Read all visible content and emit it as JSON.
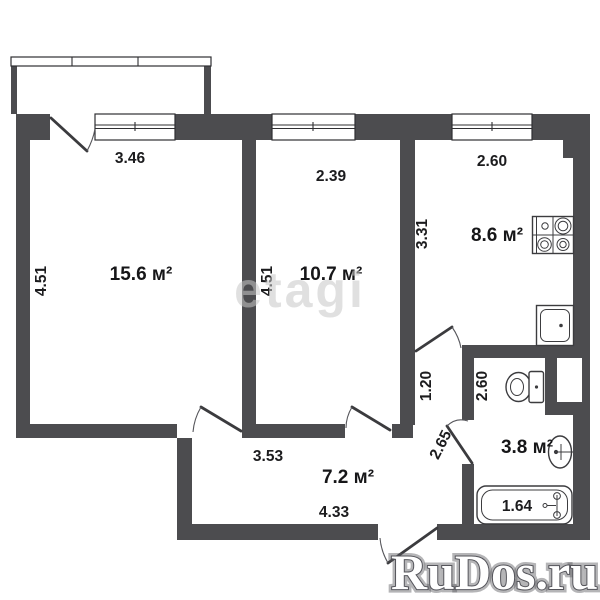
{
  "plan": {
    "rooms": [
      {
        "id": "living-room",
        "area": "15.6 м²"
      },
      {
        "id": "bedroom",
        "area": "10.7 м²"
      },
      {
        "id": "kitchen",
        "area": "8.6 м²"
      },
      {
        "id": "hallway",
        "area": "7.2 м²"
      },
      {
        "id": "bathroom",
        "area": "3.8 м²"
      }
    ],
    "dimensions": [
      {
        "id": "living-width",
        "value": "3.46"
      },
      {
        "id": "bedroom-width",
        "value": "2.39"
      },
      {
        "id": "kitchen-width",
        "value": "2.60"
      },
      {
        "id": "living-depth",
        "value": "4.51"
      },
      {
        "id": "bedroom-depth",
        "value": "4.51"
      },
      {
        "id": "kitchen-depth",
        "value": "3.31"
      },
      {
        "id": "inner-hall-width",
        "value": "1.20"
      },
      {
        "id": "bathroom-depth",
        "value": "2.60"
      },
      {
        "id": "bathroom-door",
        "value": "2.65"
      },
      {
        "id": "hallway-top-width",
        "value": "3.53"
      },
      {
        "id": "hallway-bottom-width",
        "value": "4.33"
      },
      {
        "id": "bathtub-length",
        "value": "1.64"
      }
    ],
    "fixtures": [
      "stove-icon",
      "kitchen-sink-icon",
      "toilet-icon",
      "washbasin-icon",
      "bathtub-icon"
    ],
    "watermarks": {
      "center": "etagi",
      "bottom_right": "RuDos.ru"
    },
    "colors": {
      "wall": "#4c4c4f",
      "text": "#1c1c1e",
      "watermark_center": "#c8c8c8",
      "watermark_bottom": "#ffffff"
    }
  }
}
